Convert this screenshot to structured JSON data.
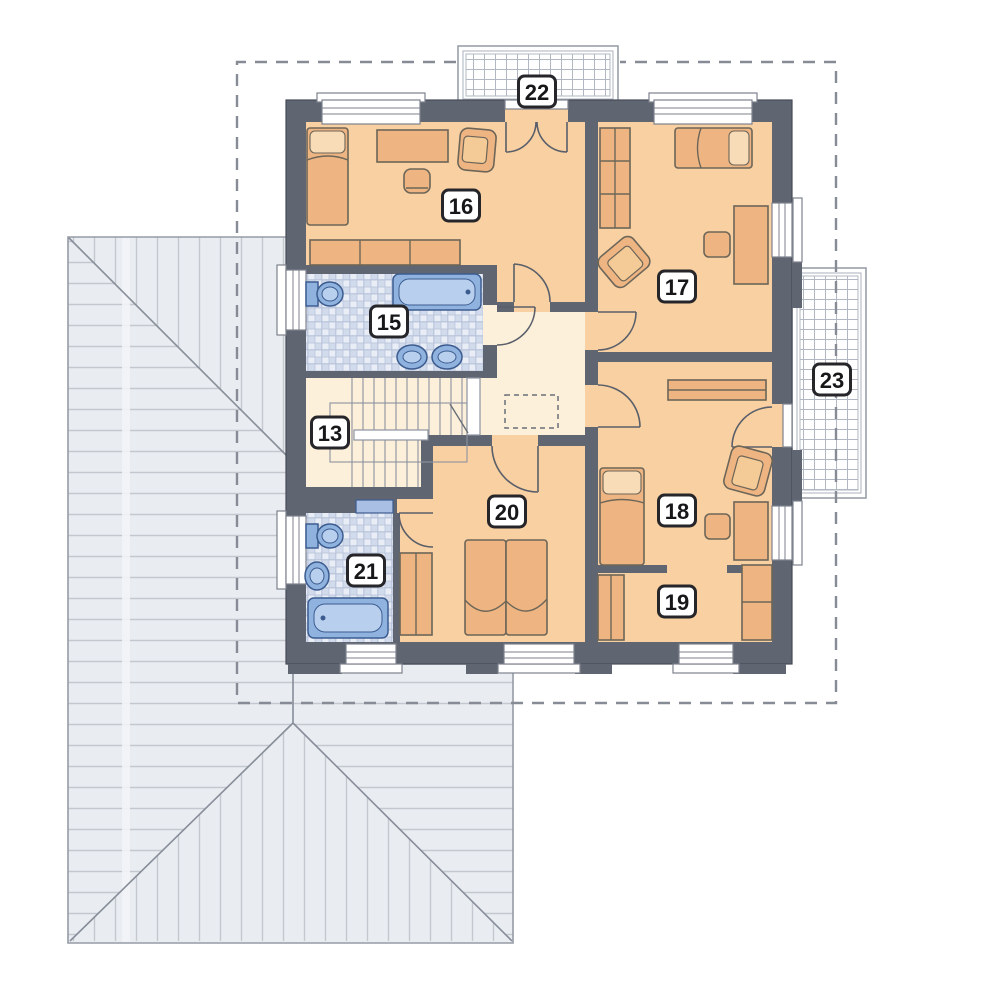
{
  "drawing": {
    "type": "architectural-floor-plan",
    "floor": "upper-floor",
    "room_labels": [
      {
        "number": "13",
        "x": 330,
        "y": 433
      },
      {
        "number": "15",
        "x": 389,
        "y": 322
      },
      {
        "number": "16",
        "x": 461,
        "y": 206
      },
      {
        "number": "17",
        "x": 677,
        "y": 287
      },
      {
        "number": "18",
        "x": 677,
        "y": 511
      },
      {
        "number": "19",
        "x": 677,
        "y": 602
      },
      {
        "number": "20",
        "x": 507,
        "y": 512
      },
      {
        "number": "21",
        "x": 366,
        "y": 571
      },
      {
        "number": "22",
        "x": 537,
        "y": 92
      },
      {
        "number": "23",
        "x": 832,
        "y": 380
      }
    ]
  },
  "colors": {
    "wall": "#5f6571",
    "room": "#f8d0a2",
    "hall": "#fcf0da",
    "furniture": "#eeb583",
    "furnitureLight": "#f4ca96",
    "pillow": "#f8dcb8",
    "furnStroke": "#6d6658",
    "fixture": "#8fb2de",
    "fixtureLight": "#b9cfee",
    "fixtureDark": "#7ba0d2",
    "fixtureStroke": "#3c5c90",
    "tileBase": "#e9edf5",
    "tileCheck": "#d2dbec",
    "tileLine": "#b6c2da",
    "roof": "#e9ecf0",
    "roofHatch": "#c3c8d0",
    "roofLine": "#959ba5",
    "hipLine": "#878e99",
    "dash": "#868b95",
    "balcLine": "#b2b8c3",
    "balcBorder": "#9aa0a9",
    "winStroke": "#7d828c",
    "doorArc": "#5a5f6a",
    "stairLine": "#8d93a0",
    "badgeBorder": "#26262a",
    "badgeText": "#17171a"
  }
}
